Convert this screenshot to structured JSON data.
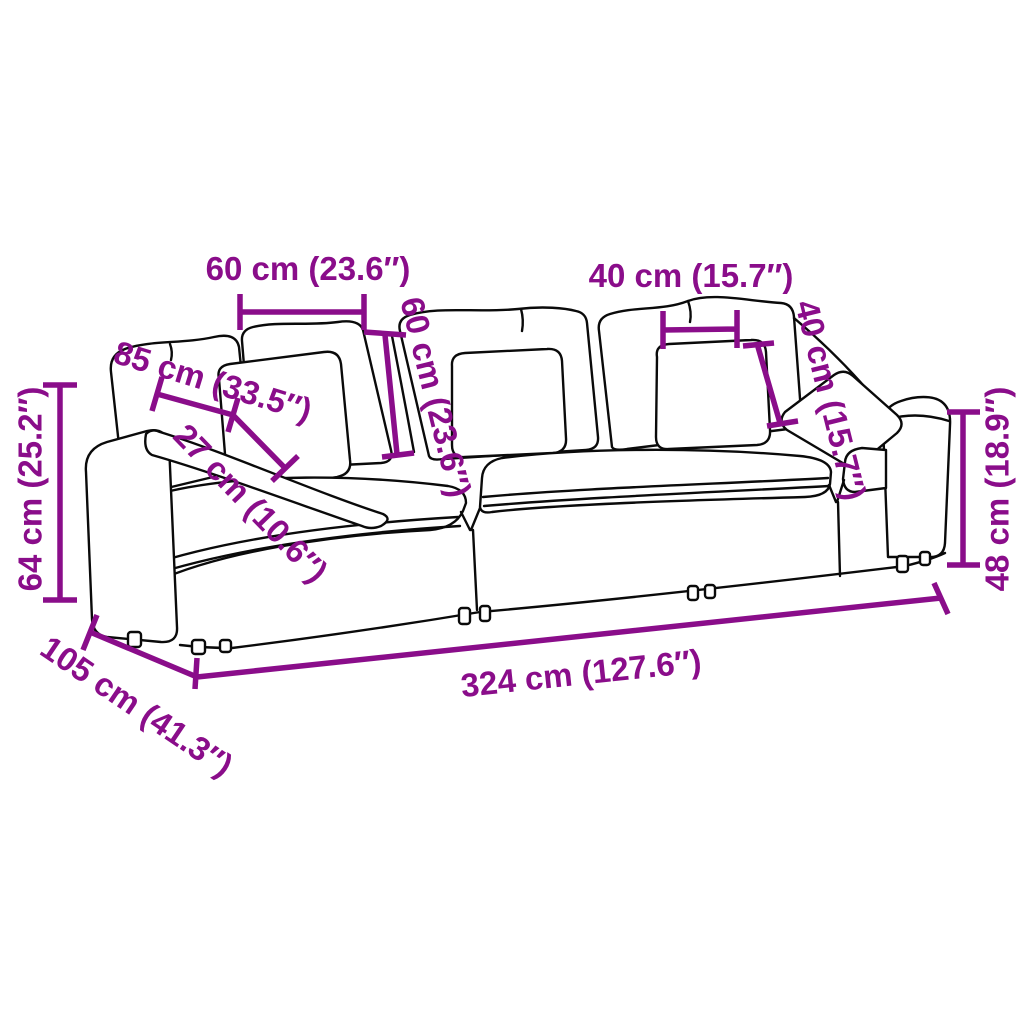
{
  "meta": {
    "image_type": "product dimension diagram",
    "subject": "3-seater modular sofa line drawing with measurements",
    "accent_color": "#8A0D8A",
    "line_color": "#0A0A0A",
    "background_color": "#FFFFFF"
  },
  "dimensions": {
    "back_cushion_width": "60 cm (23.6″)",
    "back_cushion_height": "60 cm (23.6″)",
    "seat_depth": "85 cm (33.5″)",
    "seat_thickness": "27 cm (10.6″)",
    "pillow_width": "40 cm (15.7″)",
    "pillow_height": "40 cm (15.7″)",
    "overall_height": "64 cm (25.2″)",
    "arm_height": "48 cm (18.9″)",
    "overall_depth": "105 cm (41.3″)",
    "overall_width": "324 cm (127.6″)"
  }
}
